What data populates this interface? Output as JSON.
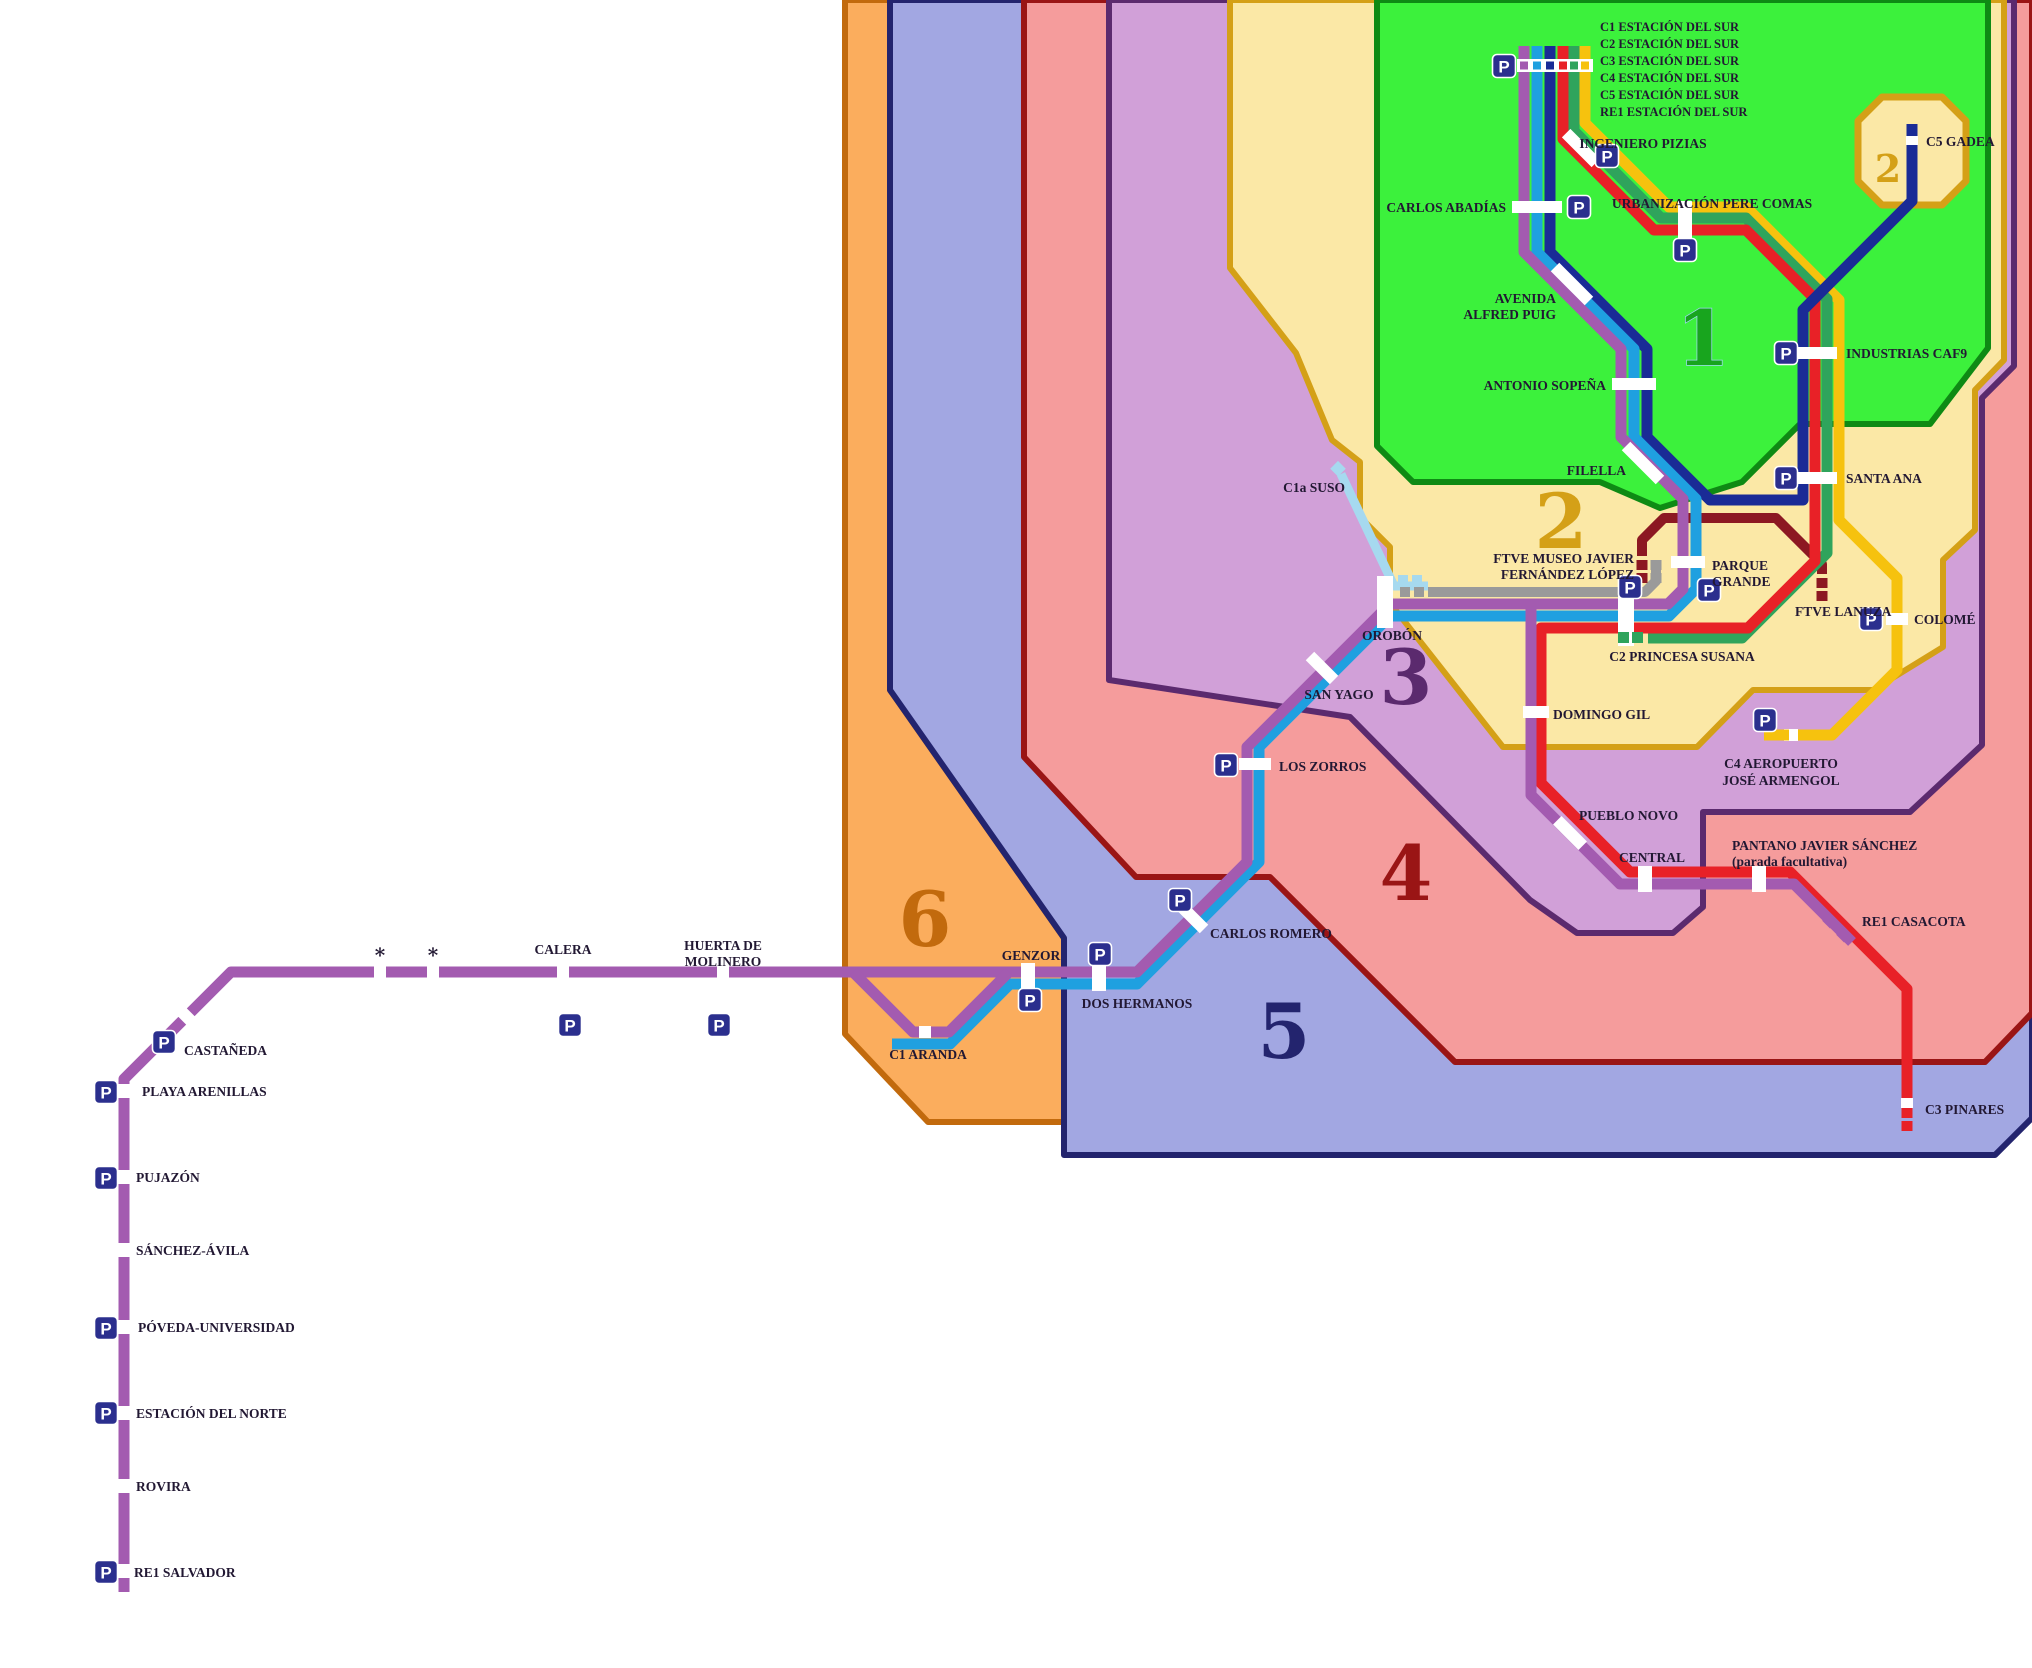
{
  "zones": [
    {
      "number": "1",
      "fill": "#3CF13C",
      "border": "#0E8A14",
      "text_color": "#18A51E"
    },
    {
      "number": "2",
      "fill": "#FBE8A6",
      "border": "#D4A017",
      "text_color": "#D4A017"
    },
    {
      "number": "3",
      "fill": "#D1A0D8",
      "border": "#5B2A6E",
      "text_color": "#5B2A6E"
    },
    {
      "number": "4",
      "fill": "#F59C9C",
      "border": "#9A1515",
      "text_color": "#9A1515"
    },
    {
      "number": "5",
      "fill": "#A2A7E2",
      "border": "#23246E",
      "text_color": "#23246E"
    },
    {
      "number": "6",
      "fill": "#FBAD5D",
      "border": "#C26A0D",
      "text_color": "#C26A0D"
    }
  ],
  "zone2_exclave_number": "2",
  "lines": {
    "c1": {
      "id": "C1",
      "color": "#1FA0E0"
    },
    "c1a": {
      "id": "C1a",
      "color": "#A6D9EF"
    },
    "c2": {
      "id": "C2",
      "color": "#2FA45C"
    },
    "c3": {
      "id": "C3",
      "color": "#E82127"
    },
    "c4": {
      "id": "C4",
      "color": "#F6C20E"
    },
    "c5": {
      "id": "C5",
      "color": "#1A2B96"
    },
    "re1": {
      "id": "RE1",
      "color": "#A35BB0"
    },
    "ftve": {
      "id": "FTVE",
      "color": "#8C1822"
    },
    "link": {
      "id": "link",
      "color": "#9A9A9A"
    }
  },
  "icons": {
    "parking_letter": "P"
  },
  "labels": {
    "esds_c1": "C1 ESTACIÓN DEL SUR",
    "esds_c2": "C2 ESTACIÓN DEL SUR",
    "esds_c3": "C3 ESTACIÓN DEL SUR",
    "esds_c4": "C4 ESTACIÓN DEL SUR",
    "esds_c5": "C5 ESTACIÓN DEL SUR",
    "esds_re1": "RE1 ESTACIÓN DEL SUR",
    "ingeniero": "INGENIERO PIZIAS",
    "urbanizacion": "URBANIZACIÓN PERE COMAS",
    "carlos_abadias": "CARLOS ABADÍAS",
    "avenida1": "AVENIDA",
    "avenida2": "ALFRED PUIG",
    "antonio": "ANTONIO SOPEÑA",
    "filella": "FILELLA",
    "gadea": "C5 GADEA",
    "industrias": "INDUSTRIAS CAF9",
    "santa_ana": "SANTA ANA",
    "colome": "COLOMÉ",
    "museo1": "FTVE MUSEO JAVIER",
    "museo2": "FERNÁNDEZ LÓPEZ",
    "parque1": "PARQUE",
    "parque2": "GRANDE",
    "lanuza": "FTVE LANUZA",
    "princesa": "C2 PRINCESA SUSANA",
    "domingo": "DOMINGO GIL",
    "aeropuerto1": "C4 AEROPUERTO",
    "aeropuerto2": "JOSÉ ARMENGOL",
    "suso": "C1a SUSO",
    "orobon": "OROBÓN",
    "san_yago": "SAN YAGO",
    "los_zorros": "LOS ZORROS",
    "carlos_romero": "CARLOS ROMERO",
    "dos_hermanos": "DOS HERMANOS",
    "genzor": "GENZOR",
    "aranda": "C1 ARANDA",
    "pueblo": "PUEBLO NOVO",
    "central": "CENTRAL",
    "pantano1": "PANTANO JAVIER SÁNCHEZ",
    "pantano2": "(parada facultativa)",
    "casacota": "RE1 CASACOTA",
    "pinares": "C3 PINARES",
    "huerta1": "HUERTA DE",
    "huerta2": "MOLINERO",
    "calera": "CALERA",
    "ast": "*",
    "castaneda": "CASTAÑEDA",
    "playa": "PLAYA ARENILLAS",
    "pujazon": "PUJAZÓN",
    "sanchez": "SÁNCHEZ-ÁVILA",
    "poveda": "PÓVEDA-UNIVERSIDAD",
    "norte": "ESTACIÓN DEL NORTE",
    "rovira": "ROVIRA",
    "salvador": "RE1 SALVADOR",
    "z1": "1",
    "z2": "2",
    "z3": "3",
    "z4": "4",
    "z5": "5",
    "z6": "6"
  }
}
